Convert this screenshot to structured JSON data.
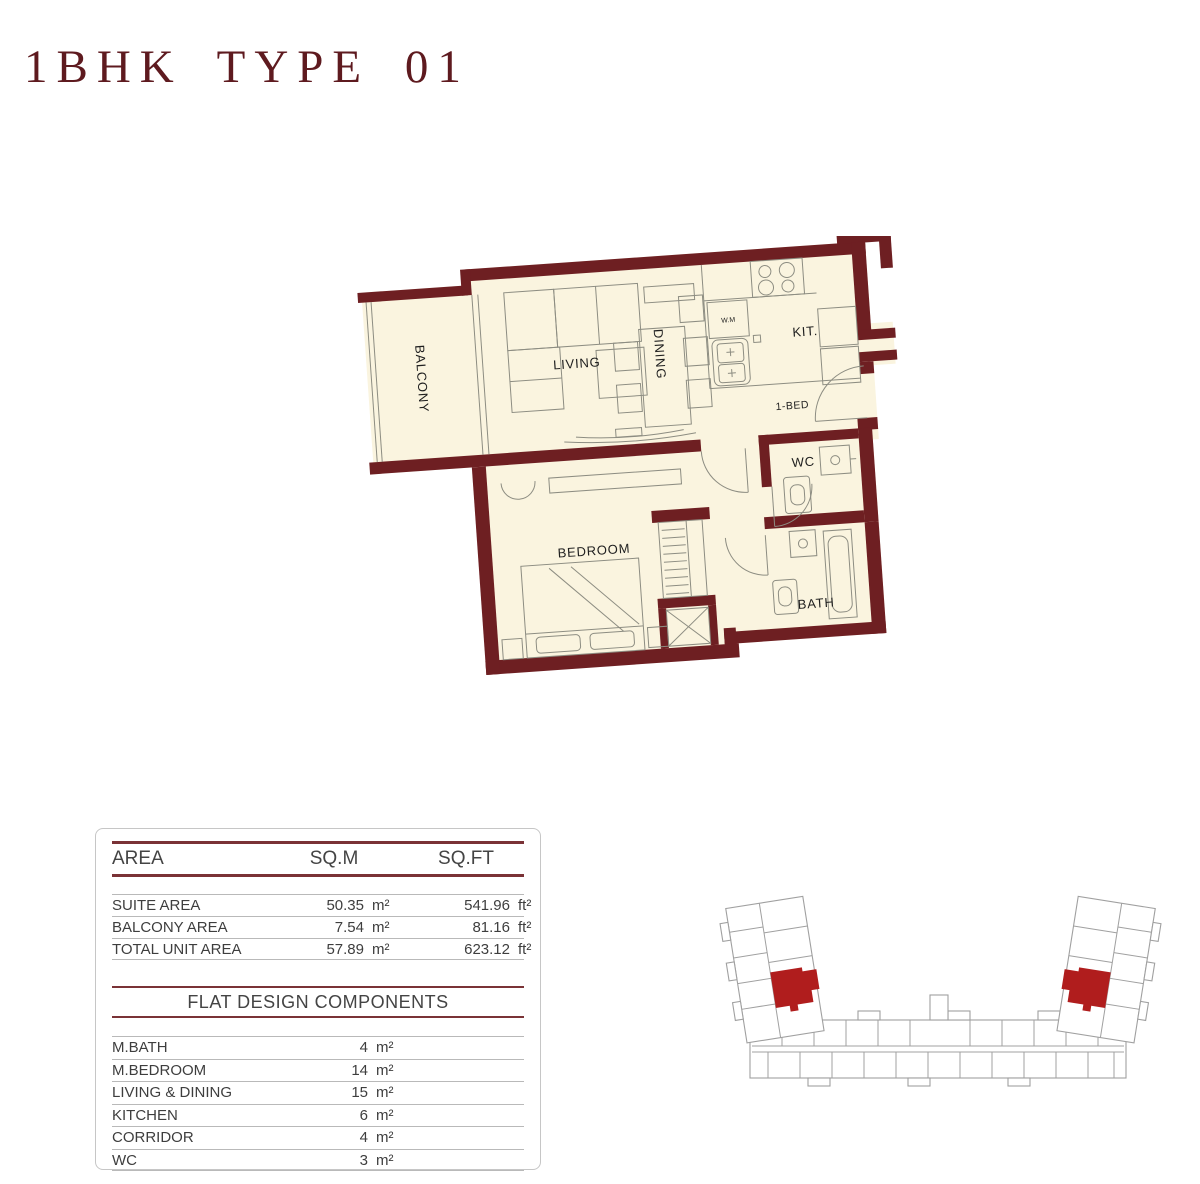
{
  "page": {
    "title": "1BHK TYPE 01"
  },
  "floorplan": {
    "labels": {
      "balcony": "BALCONY",
      "living": "LIVING",
      "dining": "DINING",
      "kitchen": "KIT.",
      "entry": "1-BED",
      "wc": "WC",
      "bedroom": "BEDROOM",
      "bath": "BATH",
      "washing_machine": "W.M"
    },
    "colors": {
      "wall": "#6e1f22",
      "floor": "#faf4df",
      "furniture_line": "#8d8d82"
    }
  },
  "area_table": {
    "headers": {
      "area": "AREA",
      "sqm": "SQ.M",
      "sqft": "SQ.FT"
    },
    "rows": [
      {
        "label": "SUITE AREA",
        "sqm": "50.35",
        "sqm_unit": "m²",
        "sqft": "541.96",
        "sqft_unit": "ft²"
      },
      {
        "label": "BALCONY AREA",
        "sqm": "7.54",
        "sqm_unit": "m²",
        "sqft": "81.16",
        "sqft_unit": "ft²"
      },
      {
        "label": "TOTAL UNIT AREA",
        "sqm": "57.89",
        "sqm_unit": "m²",
        "sqft": "623.12",
        "sqft_unit": "ft²"
      }
    ]
  },
  "components_table": {
    "title": "FLAT DESIGN COMPONENTS",
    "rows": [
      {
        "label": "M.BATH",
        "value": "4",
        "unit": "m²"
      },
      {
        "label": "M.BEDROOM",
        "value": "14",
        "unit": "m²"
      },
      {
        "label": "LIVING & DINING",
        "value": "15",
        "unit": "m²"
      },
      {
        "label": "KITCHEN",
        "value": "6",
        "unit": "m²"
      },
      {
        "label": "CORRIDOR",
        "value": "4",
        "unit": "m²"
      },
      {
        "label": "WC",
        "value": "3",
        "unit": "m²"
      }
    ]
  },
  "key_plan": {
    "highlight_color": "#b01d1d",
    "outline_color": "#a0a0a0"
  }
}
